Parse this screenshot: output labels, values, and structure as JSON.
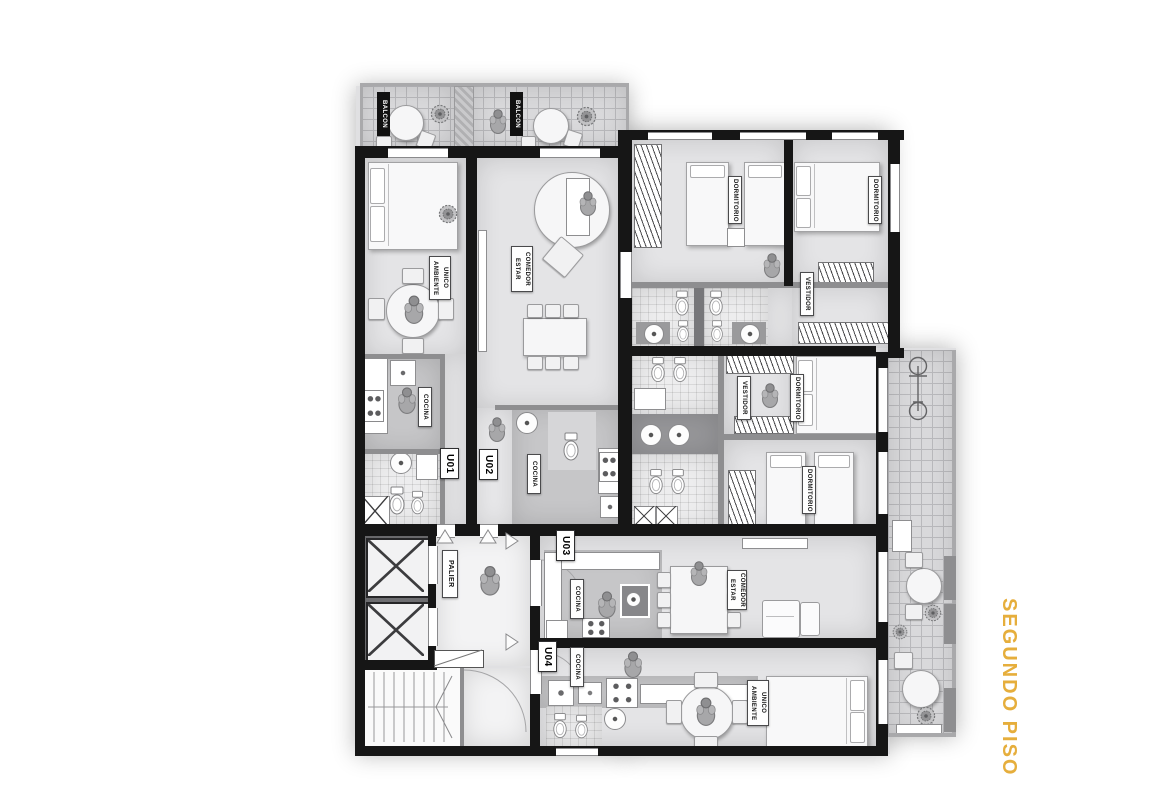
{
  "title": {
    "text": "SEGUNDO PISO",
    "color": "#E6AE3C"
  },
  "plan": {
    "units": [
      {
        "id": "U01"
      },
      {
        "id": "U02"
      },
      {
        "id": "U03"
      },
      {
        "id": "U04"
      }
    ],
    "labels": {
      "balcon_1": "BALCON",
      "balcon_2": "BALCON",
      "ambiente_unico_u01": "AMBIENTE\nUNICO",
      "estar_comedor_u02": "ESTAR\nCOMEDOR",
      "cocina_u01": "COCINA",
      "cocina_u02": "COCINA",
      "cocina_u03": "COCINA",
      "cocina_u04": "COCINA",
      "dormitorio_1": "DORMITORIO",
      "dormitorio_2": "DORMITORIO",
      "dormitorio_3": "DORMITORIO",
      "dormitorio_4": "DORMITORIO",
      "vestidor_1": "VESTIDOR",
      "vestidor_2": "VESTIDOR",
      "palier": "PALIER",
      "estar_comedor_u03": "ESTAR\nCOMEDOR",
      "ambiente_unico_u04": "AMBIENTE\nUNICO",
      "unit_u01": "U01",
      "unit_u02": "U02",
      "unit_u03": "U03",
      "unit_u04": "U04"
    },
    "colors": {
      "wall": "#161616",
      "floor": "#e4e4e6",
      "wet_floor": "#c6c6c8",
      "tile_line": "#b9b9bc",
      "accent": "#E6AE3C"
    }
  }
}
